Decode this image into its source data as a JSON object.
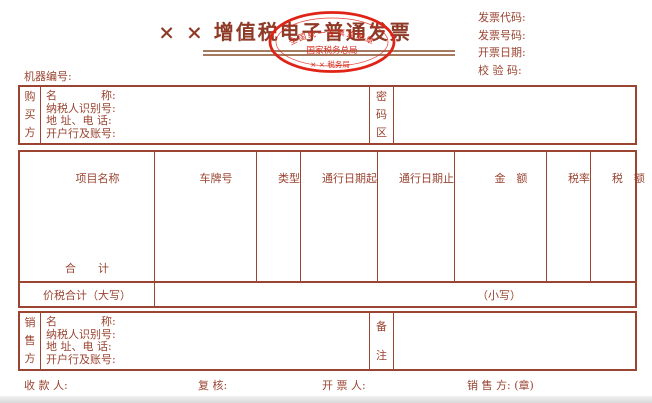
{
  "colors": {
    "line": "#9a4431",
    "text": "#9a4431",
    "title": "#8e3a26",
    "rule": "#a57a5e",
    "stamp_red": "#df2317",
    "bottom_strip": "#d9d9d9"
  },
  "header": {
    "title": "× × 增值税电子普通发票",
    "machine_label": "机器编号:",
    "meta": [
      "发票代码:",
      "发票号码:",
      "开票日期:",
      "校 验 码:"
    ],
    "stamp": {
      "top_arc": "全国统一发票监制章",
      "middle": "国家税务总局",
      "bottom": "× × 税务局"
    }
  },
  "buyer": {
    "side_label": "购买方",
    "fields": [
      "名　　　　称:",
      "纳税人识别号:",
      "地 址、电 话:",
      "开户行及账号:"
    ],
    "password_label": "密码区"
  },
  "table": {
    "headers": [
      "项目名称",
      "车牌号",
      "类型",
      "通行日期起",
      "通行日期止",
      "金　额",
      "税率",
      "税　额"
    ],
    "total_label": "合　　计",
    "tax_total_label": "价税合计（大写）",
    "lowercase_label": "（小写）"
  },
  "seller": {
    "side_label": "销售方",
    "fields": [
      "名　　　　称:",
      "纳税人识别号:",
      "地 址、电 话:",
      "开户行及账号:"
    ],
    "remark_label": "备注"
  },
  "footer": {
    "payee": "收 款 人:",
    "checker": "复 核:",
    "drawer": "开 票 人:",
    "seller_seal": "销 售 方: (章)"
  }
}
